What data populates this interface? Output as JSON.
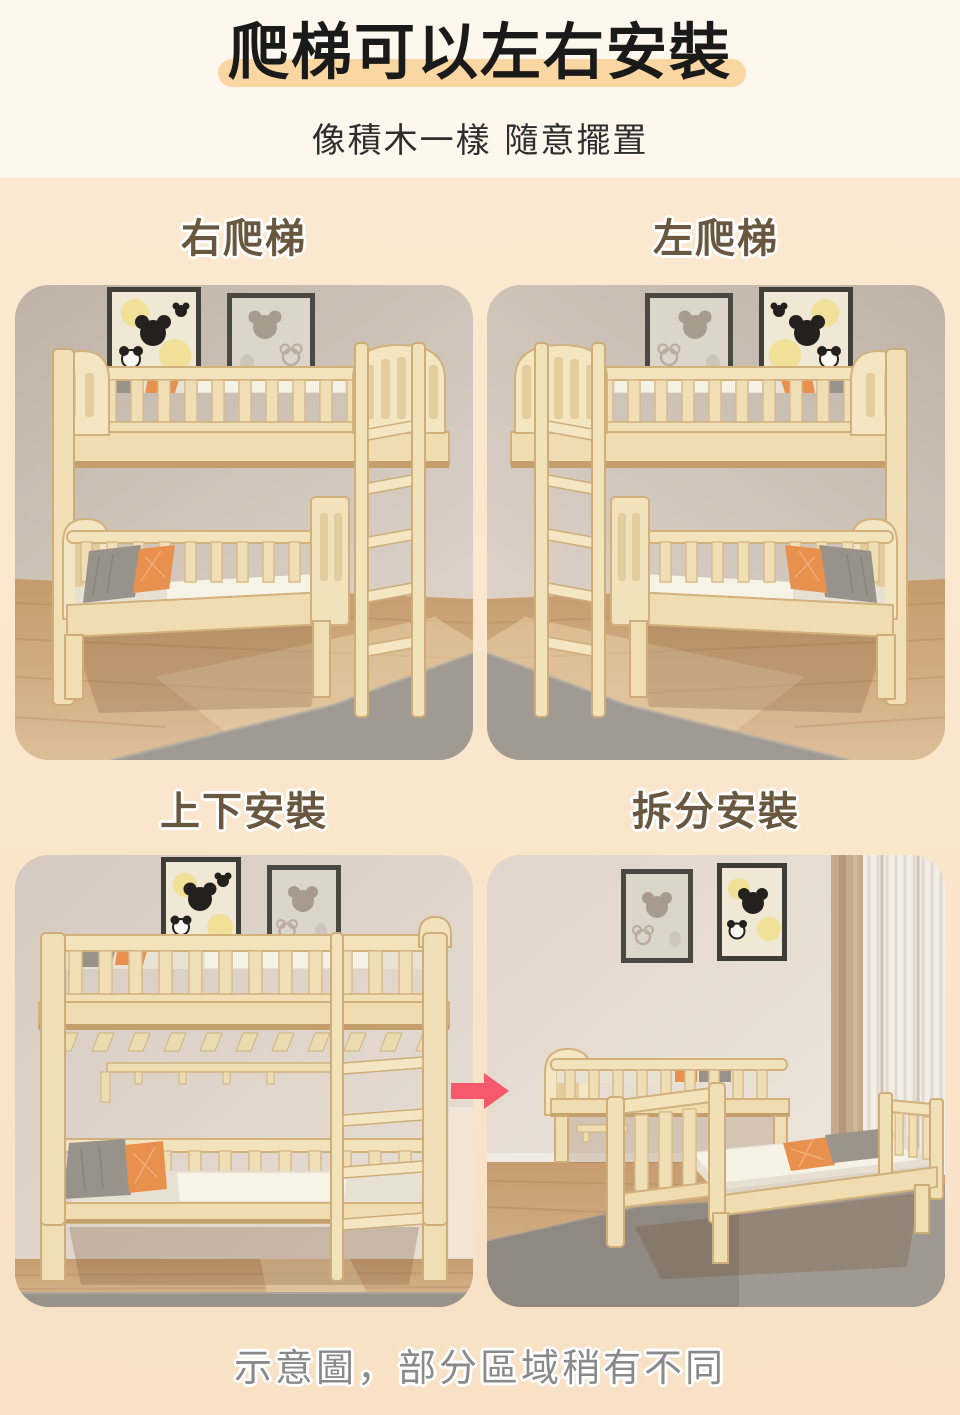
{
  "page": {
    "title": "爬梯可以左右安裝",
    "subtitle": "像積木一樣 隨意擺置",
    "caption": "示意圖，部分區域稍有不同"
  },
  "sections": [
    {
      "id": "ladder-right",
      "label": "右爬梯",
      "photo_alt": "bunk bed with climbing ladder mounted on the right side"
    },
    {
      "id": "ladder-left",
      "label": "左爬梯",
      "photo_alt": "bunk bed with climbing ladder mounted on the left side"
    },
    {
      "id": "stacked",
      "label": "上下安裝",
      "photo_alt": "bunk bed assembled as upper and lower stacked beds"
    },
    {
      "id": "split",
      "label": "拆分安裝",
      "photo_alt": "bunk bed split apart into two separate single beds"
    }
  ],
  "icons": {
    "red-arrow-icon": "➜"
  },
  "colors": {
    "background_top": "#FEF7EE",
    "background_main": "#FBE9D1",
    "background_bottom": "#F8E1C5",
    "title_text": "#1A1A1A",
    "title_highlight": "#FAD7A2",
    "section_label": "#69573F",
    "caption_text": "#8A8A8A",
    "arrow": "#F5596B",
    "bed_wood": "#F2E2BC",
    "pillow_orange": "#E8914E",
    "pillow_gray": "#98938A",
    "rug_gray": "#A19A92"
  }
}
